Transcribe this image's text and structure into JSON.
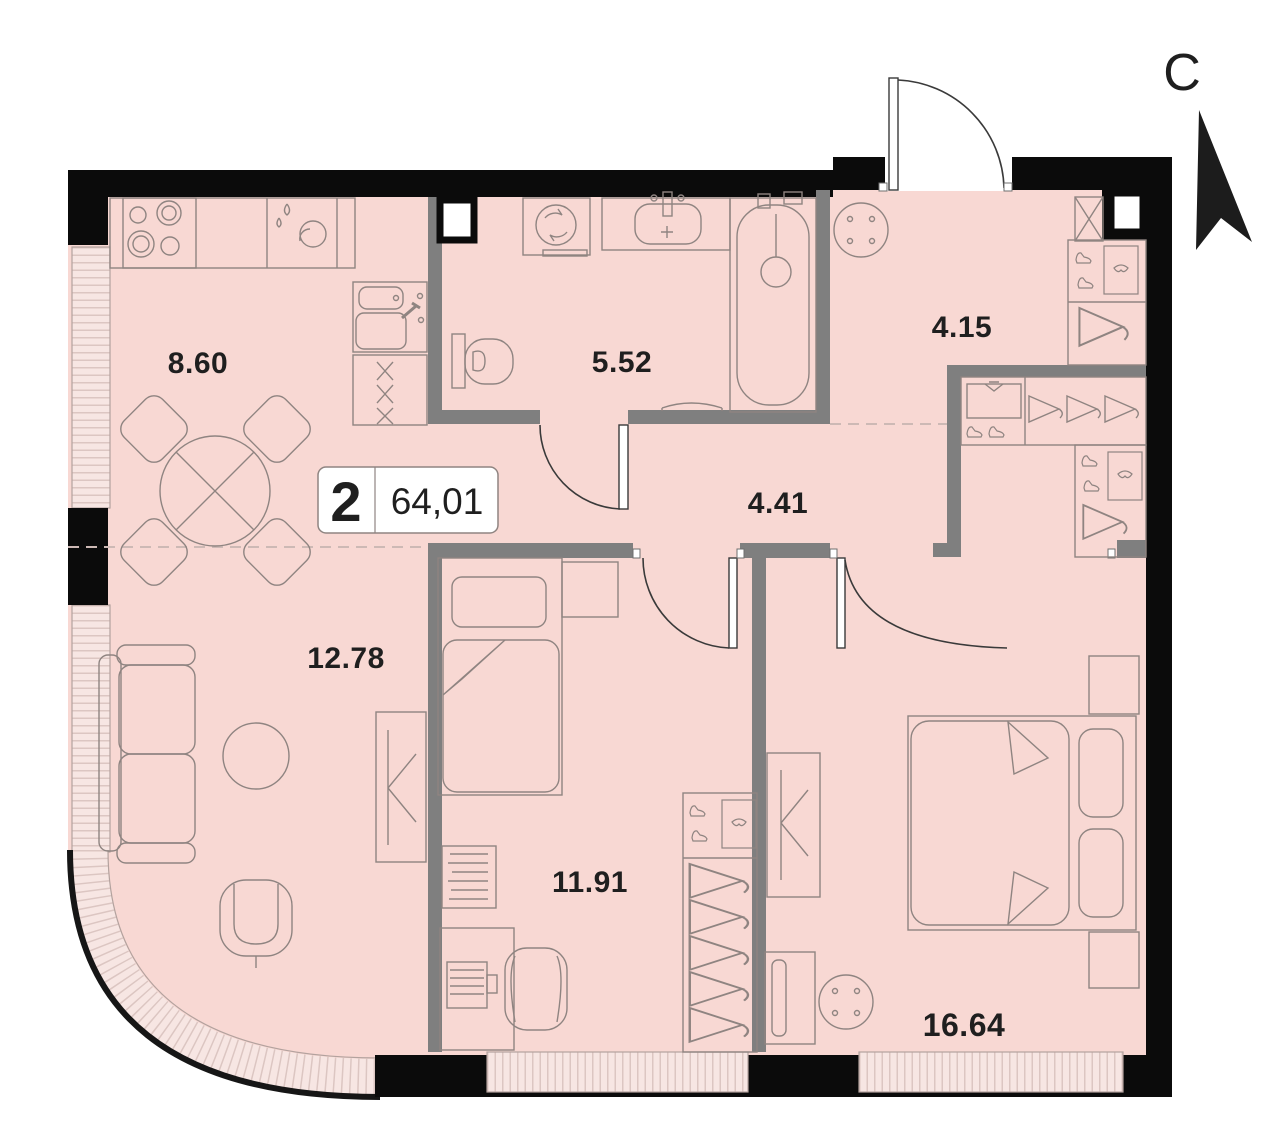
{
  "plan_title": "2-room apartment floor plan",
  "north": {
    "letter": "С"
  },
  "badge": {
    "rooms_count": "2",
    "total_area": "64,01"
  },
  "rooms": [
    {
      "name": "kitchen",
      "area": "8.60"
    },
    {
      "name": "bathroom",
      "area": "5.52"
    },
    {
      "name": "entrance-hall",
      "area": "4.15"
    },
    {
      "name": "corridor",
      "area": "4.41"
    },
    {
      "name": "living-room",
      "area": "12.78"
    },
    {
      "name": "bedroom",
      "area": "11.91"
    },
    {
      "name": "master-bedroom",
      "area": "16.64"
    }
  ],
  "colors": {
    "floor": "#f8d8d3",
    "window_band": "#f7e6e3",
    "window_hatch": "#dcc6c2",
    "exterior_wall": "#0b0b0b",
    "interior_wall": "#7f7f7f",
    "furniture_line": "#8f8481",
    "label_text": "#1f1f1f"
  }
}
